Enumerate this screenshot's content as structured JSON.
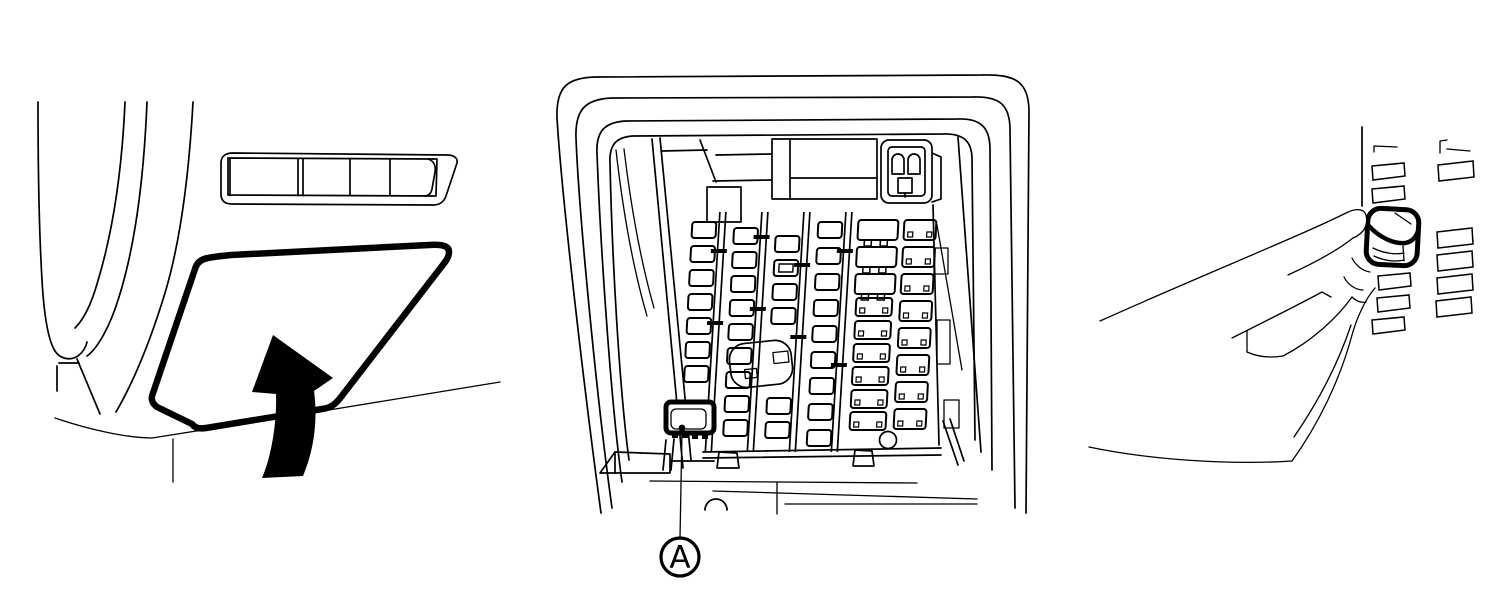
{
  "figure": {
    "type": "technical-illustration",
    "colors": {
      "line": "#000000",
      "background": "#ffffff"
    },
    "callout": {
      "label": "A"
    },
    "panels": [
      {
        "id": "cover-removal"
      },
      {
        "id": "fuse-box-location"
      },
      {
        "id": "fuse-pulling"
      }
    ]
  }
}
